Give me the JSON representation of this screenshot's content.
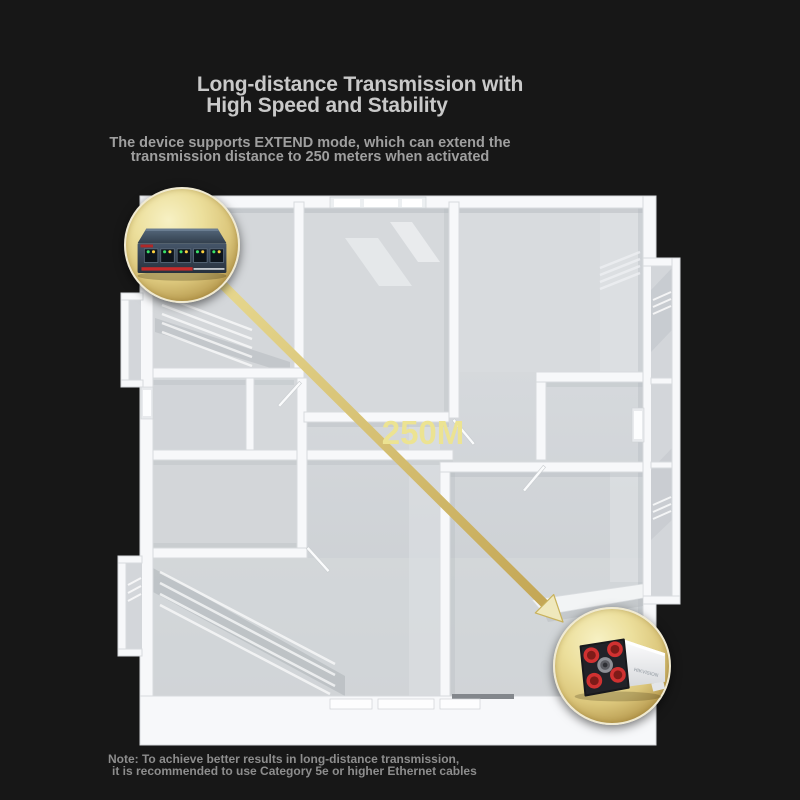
{
  "page": {
    "background_color": "#171717"
  },
  "header": {
    "title_line1": "Long-distance Transmission with",
    "title_line2": "High Speed and Stability",
    "subtitle_line1": "The device supports EXTEND mode, which can extend the",
    "subtitle_line2": "transmission distance to 250 meters when activated"
  },
  "diagram": {
    "distance_label": "250M",
    "camera": {
      "brand_label": "HIKVISION"
    },
    "colors": {
      "gold_highlight": "#f7f1c4",
      "gold_deep": "#9c7f35",
      "arrow_start": "#e6d78e",
      "arrow_end": "#c2a452",
      "arrowhead_fill": "#efe8bc",
      "distance_text": "#ece392",
      "floor_gray": "#cdd1d5",
      "wall_white": "#f7f8fa"
    }
  },
  "footer": {
    "note_line1": "Note: To achieve better results in long-distance transmission,",
    "note_line2": "it is recommended to use Category 5e or higher Ethernet cables"
  }
}
